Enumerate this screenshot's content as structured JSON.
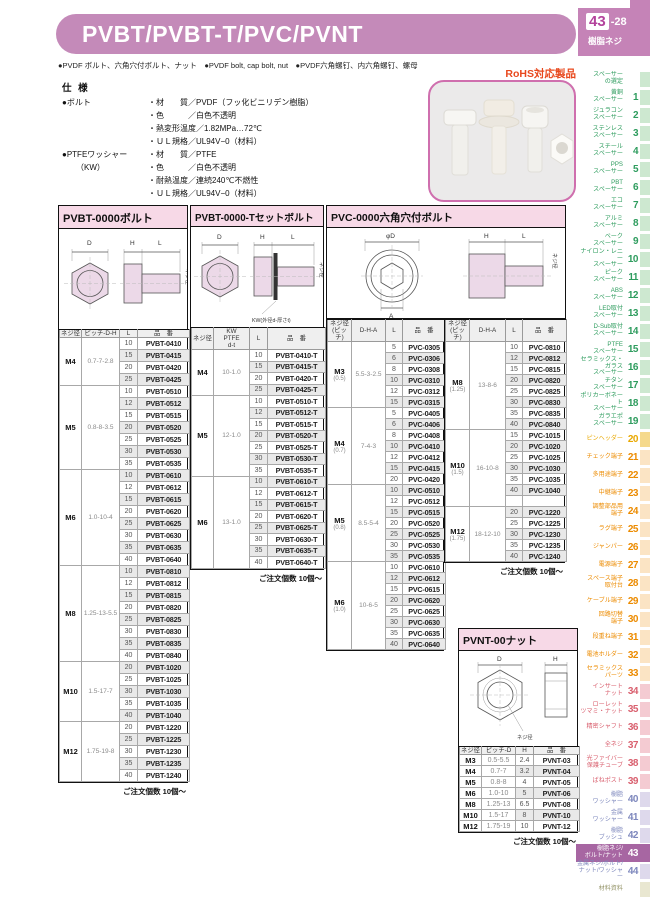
{
  "page": {
    "title": "PVBT/PVBT-T/PVC/PVNT",
    "page_num": "43",
    "page_num_suffix": "-28",
    "page_category": "樹脂ネジ",
    "bullets": "●PVDF ボルト、六角穴付ボルト、ナット　●PVDF bolt, cap bolt, nut　●PVDF六角螺钉、内六角螺钉、螺母",
    "rohs": "RoHS対応製品"
  },
  "specs": {
    "heading": "仕 様",
    "groups": [
      {
        "label": "●ボルト",
        "sublabel": "",
        "rows": [
          "・材　　質／PVDF（フッ化ビニリデン樹脂）",
          "・色　　　／白色不透明",
          "・熱変形温度／1.82MPa…72℃",
          "・ＵＬ規格／UL94V−0（材料）"
        ]
      },
      {
        "label": "●PTFEワッシャー",
        "sublabel": "（KW）",
        "rows": [
          "・材　　質／PTFE",
          "・色　　　／白色不透明",
          "・耐熱温度／連続240℃不燃性",
          "・ＵＬ規格／UL94V−0（材料）"
        ]
      }
    ]
  },
  "diagrams": {
    "pvbt": {
      "d": "D",
      "h": "H",
      "l": "L",
      "thread": "ネジ径"
    },
    "pvbt_t": {
      "d": "D",
      "h": "H",
      "l": "L",
      "thread": "ネジ径",
      "kw_note": "KW(外径d-厚さt)"
    },
    "pvc": {
      "dia": "φD",
      "a": "A",
      "h": "H",
      "l": "L",
      "thread": "ネジ径"
    },
    "pvnt": {
      "d": "D",
      "h": "H",
      "thread": "ネジ径"
    }
  },
  "tables": {
    "pvbt": {
      "title": "PVBT-0000ボルト",
      "headers": [
        "ネジ径",
        "ピッチ-D-H",
        "L",
        "品　番"
      ],
      "groups": [
        {
          "size": "M4",
          "spec": "0.7-7-2.8",
          "rows": [
            [
              "10",
              "PVBT-0410"
            ],
            [
              "15",
              "PVBT-0415"
            ],
            [
              "20",
              "PVBT-0420"
            ],
            [
              "25",
              "PVBT-0425"
            ]
          ]
        },
        {
          "size": "M5",
          "spec": "0.8-8-3.5",
          "rows": [
            [
              "10",
              "PVBT-0510"
            ],
            [
              "12",
              "PVBT-0512"
            ],
            [
              "15",
              "PVBT-0515"
            ],
            [
              "20",
              "PVBT-0520"
            ],
            [
              "25",
              "PVBT-0525"
            ],
            [
              "30",
              "PVBT-0530"
            ],
            [
              "35",
              "PVBT-0535"
            ]
          ]
        },
        {
          "size": "M6",
          "spec": "1.0-10-4",
          "rows": [
            [
              "10",
              "PVBT-0610"
            ],
            [
              "12",
              "PVBT-0612"
            ],
            [
              "15",
              "PVBT-0615"
            ],
            [
              "20",
              "PVBT-0620"
            ],
            [
              "25",
              "PVBT-0625"
            ],
            [
              "30",
              "PVBT-0630"
            ],
            [
              "35",
              "PVBT-0635"
            ],
            [
              "40",
              "PVBT-0640"
            ]
          ]
        },
        {
          "size": "M8",
          "spec": "1.25-13-5.5",
          "rows": [
            [
              "10",
              "PVBT-0810"
            ],
            [
              "12",
              "PVBT-0812"
            ],
            [
              "15",
              "PVBT-0815"
            ],
            [
              "20",
              "PVBT-0820"
            ],
            [
              "25",
              "PVBT-0825"
            ],
            [
              "30",
              "PVBT-0830"
            ],
            [
              "35",
              "PVBT-0835"
            ],
            [
              "40",
              "PVBT-0840"
            ]
          ]
        },
        {
          "size": "M10",
          "spec": "1.5-17-7",
          "rows": [
            [
              "20",
              "PVBT-1020"
            ],
            [
              "25",
              "PVBT-1025"
            ],
            [
              "30",
              "PVBT-1030"
            ],
            [
              "35",
              "PVBT-1035"
            ],
            [
              "40",
              "PVBT-1040"
            ]
          ]
        },
        {
          "size": "M12",
          "spec": "1.75-19-8",
          "rows": [
            [
              "20",
              "PVBT-1220"
            ],
            [
              "25",
              "PVBT-1225"
            ],
            [
              "30",
              "PVBT-1230"
            ],
            [
              "35",
              "PVBT-1235"
            ],
            [
              "40",
              "PVBT-1240"
            ]
          ]
        }
      ],
      "note": "ご注文個数 10個〜"
    },
    "pvbt_t": {
      "title": "PVBT-0000-Tセットボルト",
      "headers": [
        "ネジ径",
        "KW\nPTFE\nd-t",
        "L",
        "品　番"
      ],
      "groups": [
        {
          "size": "M4",
          "spec": "10-1.0",
          "rows": [
            [
              "10",
              "PVBT-0410-T"
            ],
            [
              "15",
              "PVBT-0415-T"
            ],
            [
              "20",
              "PVBT-0420-T"
            ],
            [
              "25",
              "PVBT-0425-T"
            ]
          ]
        },
        {
          "size": "M5",
          "spec": "12-1.0",
          "rows": [
            [
              "10",
              "PVBT-0510-T"
            ],
            [
              "12",
              "PVBT-0512-T"
            ],
            [
              "15",
              "PVBT-0515-T"
            ],
            [
              "20",
              "PVBT-0520-T"
            ],
            [
              "25",
              "PVBT-0525-T"
            ],
            [
              "30",
              "PVBT-0530-T"
            ],
            [
              "35",
              "PVBT-0535-T"
            ]
          ]
        },
        {
          "size": "M6",
          "spec": "13-1.0",
          "rows": [
            [
              "10",
              "PVBT-0610-T"
            ],
            [
              "12",
              "PVBT-0612-T"
            ],
            [
              "15",
              "PVBT-0615-T"
            ],
            [
              "20",
              "PVBT-0620-T"
            ],
            [
              "25",
              "PVBT-0625-T"
            ],
            [
              "30",
              "PVBT-0630-T"
            ],
            [
              "35",
              "PVBT-0635-T"
            ],
            [
              "40",
              "PVBT-0640-T"
            ]
          ]
        }
      ],
      "note": "ご注文個数 10個〜"
    },
    "pvc": {
      "title": "PVC-0000六角穴付ボルト",
      "headers": [
        "ネジ径\n(ピッチ)",
        "D-H-A",
        "L",
        "品　番"
      ],
      "left_groups": [
        {
          "size": "M3",
          "pitch": "(0.5)",
          "spec": "5.5-3-2.5",
          "rows": [
            [
              "5",
              "PVC-0305"
            ],
            [
              "6",
              "PVC-0306"
            ],
            [
              "8",
              "PVC-0308"
            ],
            [
              "10",
              "PVC-0310"
            ],
            [
              "12",
              "PVC-0312"
            ],
            [
              "15",
              "PVC-0315"
            ]
          ]
        },
        {
          "size": "M4",
          "pitch": "(0.7)",
          "spec": "7-4-3",
          "rows": [
            [
              "5",
              "PVC-0405"
            ],
            [
              "6",
              "PVC-0406"
            ],
            [
              "8",
              "PVC-0408"
            ],
            [
              "10",
              "PVC-0410"
            ],
            [
              "12",
              "PVC-0412"
            ],
            [
              "15",
              "PVC-0415"
            ],
            [
              "20",
              "PVC-0420"
            ]
          ]
        },
        {
          "size": "M5",
          "pitch": "(0.8)",
          "spec": "8.5-5-4",
          "rows": [
            [
              "10",
              "PVC-0510"
            ],
            [
              "12",
              "PVC-0512"
            ],
            [
              "15",
              "PVC-0515"
            ],
            [
              "20",
              "PVC-0520"
            ],
            [
              "25",
              "PVC-0525"
            ],
            [
              "30",
              "PVC-0530"
            ],
            [
              "35",
              "PVC-0535"
            ]
          ]
        },
        {
          "size": "M6",
          "pitch": "(1.0)",
          "spec": "10-6-5",
          "rows": [
            [
              "10",
              "PVC-0610"
            ],
            [
              "12",
              "PVC-0612"
            ],
            [
              "15",
              "PVC-0615"
            ],
            [
              "20",
              "PVC-0620"
            ],
            [
              "25",
              "PVC-0625"
            ],
            [
              "30",
              "PVC-0630"
            ],
            [
              "35",
              "PVC-0635"
            ],
            [
              "40",
              "PVC-0640"
            ]
          ]
        }
      ],
      "right_groups": [
        {
          "size": "M8",
          "pitch": "(1.25)",
          "spec": "13-8-6",
          "rows": [
            [
              "10",
              "PVC-0810"
            ],
            [
              "12",
              "PVC-0812"
            ],
            [
              "15",
              "PVC-0815"
            ],
            [
              "20",
              "PVC-0820"
            ],
            [
              "25",
              "PVC-0825"
            ],
            [
              "30",
              "PVC-0830"
            ],
            [
              "35",
              "PVC-0835"
            ],
            [
              "40",
              "PVC-0840"
            ]
          ]
        },
        {
          "size": "M10",
          "pitch": "(1.5)",
          "spec": "16-10-8",
          "rows": [
            [
              "15",
              "PVC-1015"
            ],
            [
              "20",
              "PVC-1020"
            ],
            [
              "25",
              "PVC-1025"
            ],
            [
              "30",
              "PVC-1030"
            ],
            [
              "35",
              "PVC-1035"
            ],
            [
              "40",
              "PVC-1040"
            ],
            [
              "",
              ""
            ]
          ]
        },
        {
          "size": "M12",
          "pitch": "(1.75)",
          "spec": "18-12-10",
          "rows": [
            [
              "20",
              "PVC-1220"
            ],
            [
              "25",
              "PVC-1225"
            ],
            [
              "30",
              "PVC-1230"
            ],
            [
              "35",
              "PVC-1235"
            ],
            [
              "40",
              "PVC-1240"
            ]
          ]
        }
      ],
      "note": "ご注文個数 10個〜"
    },
    "pvnt": {
      "title": "PVNT-00ナット",
      "headers": [
        "ネジ径",
        "ピッチ-D",
        "H",
        "品　番"
      ],
      "rows": [
        [
          "M3",
          "0.5-5.5",
          "2.4",
          "PVNT-03"
        ],
        [
          "M4",
          "0.7-7",
          "3.2",
          "PVNT-04"
        ],
        [
          "M5",
          "0.8-8",
          "4",
          "PVNT-05"
        ],
        [
          "M6",
          "1.0-10",
          "5",
          "PVNT-06"
        ],
        [
          "M8",
          "1.25-13",
          "6.5",
          "PVNT-08"
        ],
        [
          "M10",
          "1.5-17",
          "8",
          "PVNT-10"
        ],
        [
          "M12",
          "1.75-19",
          "10",
          "PVNT-12"
        ]
      ],
      "note": "ご注文個数 10個〜"
    }
  },
  "sidebar": {
    "items": [
      {
        "label": "スペーサー\nの選定",
        "num": "",
        "group": "green"
      },
      {
        "label": "黄銅\nスペーサー",
        "num": "1",
        "group": "green"
      },
      {
        "label": "ジュラコン\nスペーサー",
        "num": "2",
        "group": "green"
      },
      {
        "label": "ステンレス\nスペーサー",
        "num": "3",
        "group": "green"
      },
      {
        "label": "スチール\nスペーサー",
        "num": "4",
        "group": "green"
      },
      {
        "label": "PPS\nスペーサー",
        "num": "5",
        "group": "green"
      },
      {
        "label": "PBT\nスペーサー",
        "num": "6",
        "group": "green"
      },
      {
        "label": "エコ\nスペーサー",
        "num": "7",
        "group": "green"
      },
      {
        "label": "アルミ\nスペーサー",
        "num": "8",
        "group": "green"
      },
      {
        "label": "ベーク\nスペーサー",
        "num": "9",
        "group": "green"
      },
      {
        "label": "ナイロン・レニー\nスペーサー",
        "num": "10",
        "group": "green"
      },
      {
        "label": "ピーク\nスペーサー",
        "num": "11",
        "group": "green"
      },
      {
        "label": "ABS\nスペーサー",
        "num": "12",
        "group": "green"
      },
      {
        "label": "LED取付\nスペーサー",
        "num": "13",
        "group": "green"
      },
      {
        "label": "D-Sub取付\nスペーサー",
        "num": "14",
        "group": "green"
      },
      {
        "label": "PTFE\nスペーサー",
        "num": "15",
        "group": "green"
      },
      {
        "label": "セラミックス・ガラス\nスペーサー",
        "num": "16",
        "group": "green"
      },
      {
        "label": "チタン\nスペーサー",
        "num": "17",
        "group": "green"
      },
      {
        "label": "ポリカーボネート\nスペーサー",
        "num": "18",
        "group": "green"
      },
      {
        "label": "ガラエポ\nスペーサー",
        "num": "19",
        "group": "green"
      },
      {
        "label": "ピンヘッダー",
        "num": "20",
        "group": "gold"
      },
      {
        "label": "チェック端子",
        "num": "21",
        "group": "orange"
      },
      {
        "label": "多用途端子",
        "num": "22",
        "group": "orange"
      },
      {
        "label": "中継端子",
        "num": "23",
        "group": "orange"
      },
      {
        "label": "調整部品用\n端子",
        "num": "24",
        "group": "orange"
      },
      {
        "label": "ラグ端子",
        "num": "25",
        "group": "orange"
      },
      {
        "label": "ジャンパー",
        "num": "26",
        "group": "orange"
      },
      {
        "label": "電源端子",
        "num": "27",
        "group": "orange"
      },
      {
        "label": "スペース端子\n取付台",
        "num": "28",
        "group": "orange"
      },
      {
        "label": "ケーブル端子",
        "num": "29",
        "group": "orange"
      },
      {
        "label": "回路切替\n端子",
        "num": "30",
        "group": "orange"
      },
      {
        "label": "段重ね端子",
        "num": "31",
        "group": "orange"
      },
      {
        "label": "電池ホルダー",
        "num": "32",
        "group": "orange"
      },
      {
        "label": "セラミックス\nパーツ",
        "num": "33",
        "group": "orange"
      },
      {
        "label": "インサート\nナット",
        "num": "34",
        "group": "red"
      },
      {
        "label": "ローレット\nツマミ・ナット",
        "num": "35",
        "group": "red"
      },
      {
        "label": "精密シャフト",
        "num": "36",
        "group": "red"
      },
      {
        "label": "全ネジ",
        "num": "37",
        "group": "red"
      },
      {
        "label": "光ファイバー\n保護チューブ",
        "num": "38",
        "group": "red"
      },
      {
        "label": "ばねポスト",
        "num": "39",
        "group": "red"
      },
      {
        "label": "樹脂\nワッシャー",
        "num": "40",
        "group": "blue"
      },
      {
        "label": "金属\nワッシャー",
        "num": "41",
        "group": "blue"
      },
      {
        "label": "樹脂\nブッシュ",
        "num": "42",
        "group": "blue"
      },
      {
        "label": "樹脂ネジ/\nボルト/ナット",
        "num": "43",
        "group": "blue active-item"
      },
      {
        "label": "金属ネジ/ボルト/\nナット/ワッシャー",
        "num": "44",
        "group": "blue"
      },
      {
        "label": "材料資料",
        "num": "",
        "group": "beige"
      }
    ]
  }
}
